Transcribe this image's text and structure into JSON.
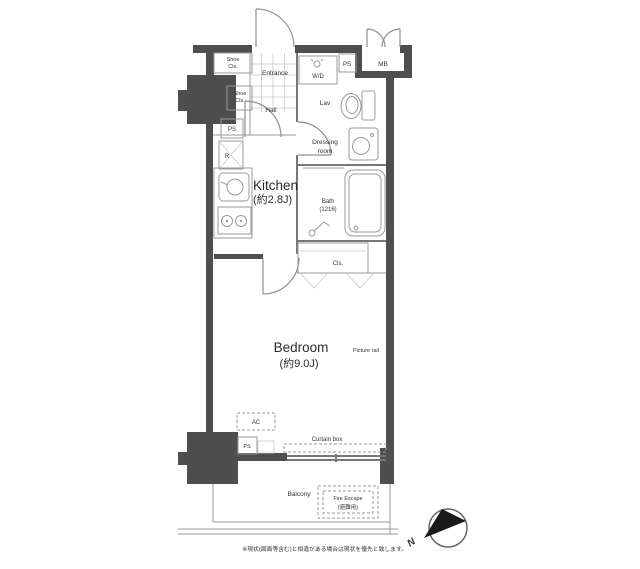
{
  "floor_plan": {
    "entrance": {
      "label": "Entrance"
    },
    "hall": {
      "label": "Hall"
    },
    "shoe_closet_upper": {
      "line1": "Shoe",
      "line2": "Cls."
    },
    "shoe_closet_lower": {
      "line1": "Shoe",
      "line2": "Cls."
    },
    "pipe_space_entrance": {
      "label": "PS"
    },
    "refrigerator": {
      "label": "R"
    },
    "kitchen": {
      "name": "Kitchen",
      "size": "(約2.8J)"
    },
    "washer_dryer": {
      "label": "W/D"
    },
    "pipe_space_top": {
      "label": "PS"
    },
    "meter_box": {
      "label": "MB"
    },
    "lavatory": {
      "label": "Lav"
    },
    "dressing_room": {
      "line1": "Dressing",
      "line2": "room"
    },
    "bath": {
      "name": "Bath",
      "size": "(1216)"
    },
    "closet": {
      "label": "Cls."
    },
    "bedroom": {
      "name": "Bedroom",
      "size": "(約9.0J)"
    },
    "picture_rail": {
      "label": "Picture rail"
    },
    "air_conditioner": {
      "label": "AC"
    },
    "pipe_space_bottom": {
      "label": "PS"
    },
    "curtain_box": {
      "label": "Curtain box"
    },
    "balcony": {
      "label": "Balcony"
    },
    "fire_escape": {
      "line1": "Fire Escape",
      "line2": "(避難用)"
    },
    "compass": {
      "label": "N"
    },
    "footnote": "※現状(図面等含む)と相違がある場合は現状を優先と致します。"
  }
}
